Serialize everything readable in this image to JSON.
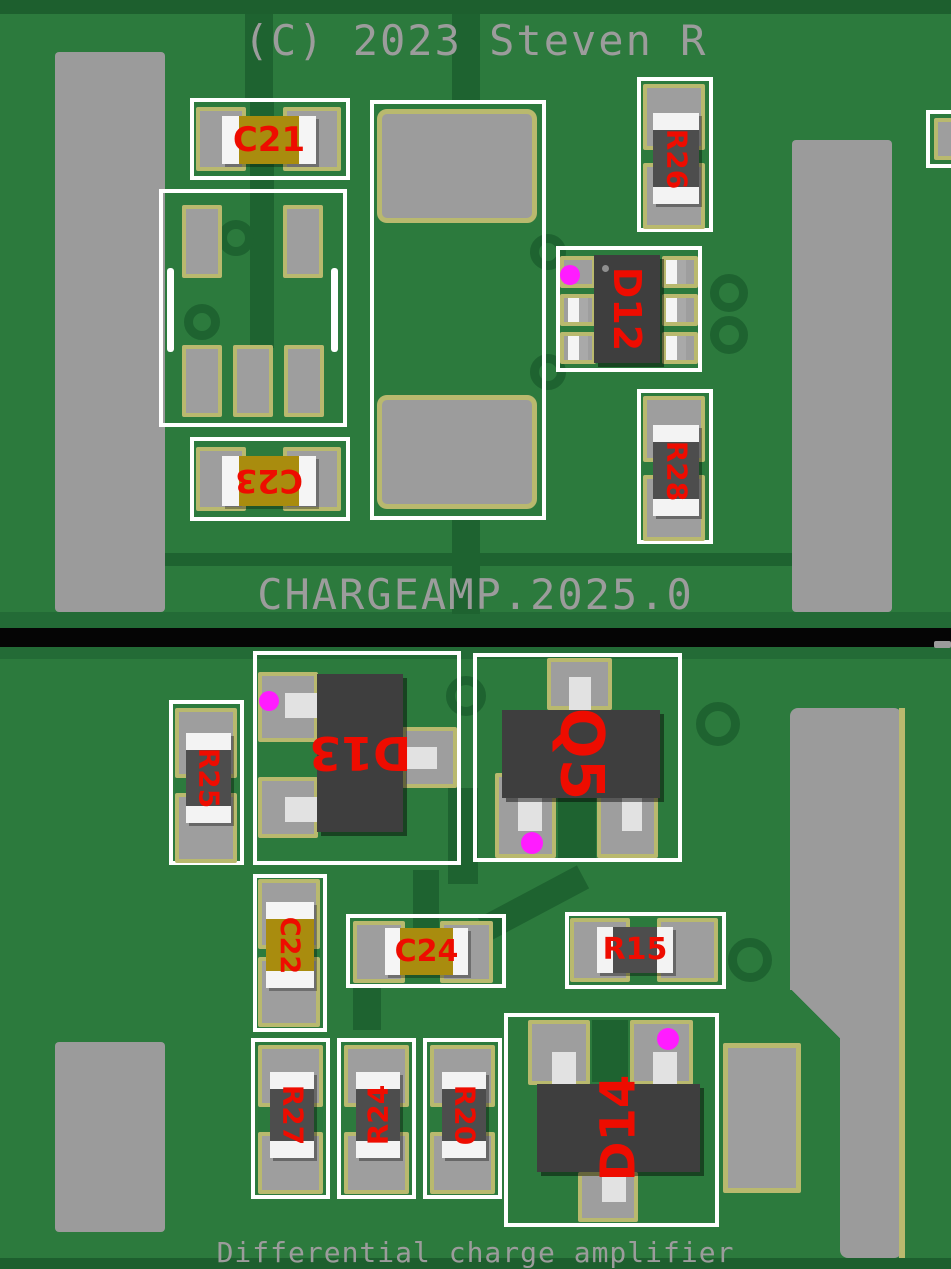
{
  "silkscreen": {
    "copyright": "(C) 2023 Steven R",
    "board_id": "CHARGEAMP.2025.0",
    "subtitle": "Differential charge amplifier"
  },
  "labels": {
    "C21": "C21",
    "C23": "C23",
    "R26": "R26",
    "R28": "R28",
    "D12": "D12",
    "R25": "R25",
    "D13": "D13",
    "Q5": "Q5",
    "C22": "C22",
    "C24": "C24",
    "R15": "R15",
    "R27": "R27",
    "R24": "R24",
    "R20": "R20",
    "D14": "D14"
  },
  "boards": {
    "top": {
      "populated_components": [
        "C21",
        "C23",
        "R26",
        "R28",
        "D12"
      ],
      "unpopulated_footprints": 3
    },
    "bottom": {
      "populated_components": [
        "R25",
        "D13",
        "Q5",
        "C22",
        "C24",
        "R15",
        "R27",
        "R24",
        "R20",
        "D14"
      ],
      "unpopulated_footprints": 1
    }
  },
  "colors": {
    "board_green": "#2c7a3d",
    "trace_dark_green": "#1e6330",
    "copper_gray": "#9b9b9b",
    "pad_outline_khaki": "#b9b96e",
    "component_body_gray": "#3e3e3e",
    "resistor_body_gray": "#4d4d4d",
    "capacitor_tan": "#a98c0e",
    "silkscreen_red": "#ee0c00",
    "silkscreen_gray": "#9c9c9c",
    "courtyard_white": "#ffffff",
    "pin1_marker_magenta": "#ff1cff",
    "divider_black": "#050505"
  }
}
